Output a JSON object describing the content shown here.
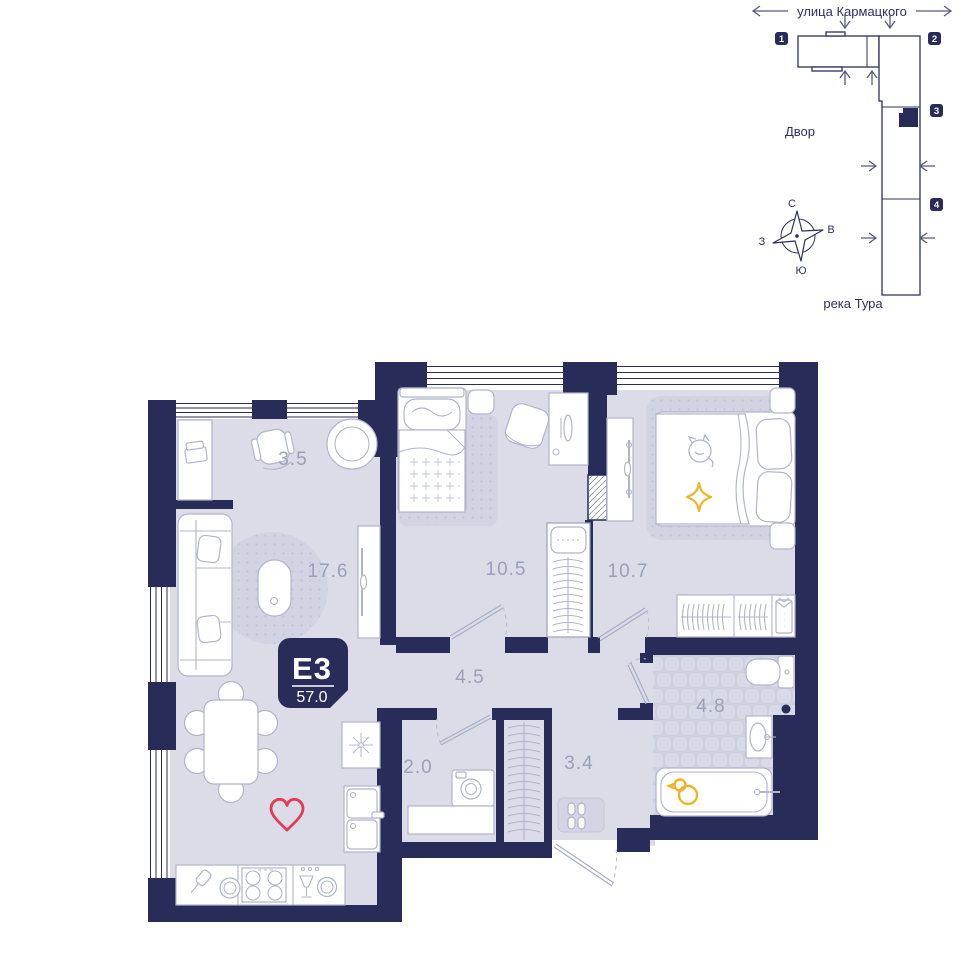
{
  "site_plan": {
    "street_label": "улица Кармацкого",
    "courtyard_label": "Двор",
    "river_label": "река Тура",
    "compass": {
      "north": "С",
      "east": "В",
      "south": "Ю",
      "west": "З"
    },
    "buildings": [
      {
        "number": "1"
      },
      {
        "number": "2"
      },
      {
        "number": "3"
      },
      {
        "number": "4"
      }
    ]
  },
  "apartment": {
    "unit_label": "E3",
    "total_area": "57.0",
    "rooms": [
      {
        "name": "workspace-loggia",
        "area": "3.5"
      },
      {
        "name": "living-kitchen",
        "area": "17.6"
      },
      {
        "name": "bedroom-1",
        "area": "10.5"
      },
      {
        "name": "bedroom-2",
        "area": "10.7"
      },
      {
        "name": "hallway",
        "area": "4.5"
      },
      {
        "name": "laundry",
        "area": "2.0"
      },
      {
        "name": "entry-hall",
        "area": "3.4"
      },
      {
        "name": "bathroom",
        "area": "4.8"
      }
    ]
  },
  "colors": {
    "wall": "#272c58",
    "floor": "#dbdce8",
    "accent_red": "#e23b53",
    "accent_yellow": "#f0b429",
    "area_label_text": "#9aa0ba",
    "site_text": "#2b3060"
  }
}
